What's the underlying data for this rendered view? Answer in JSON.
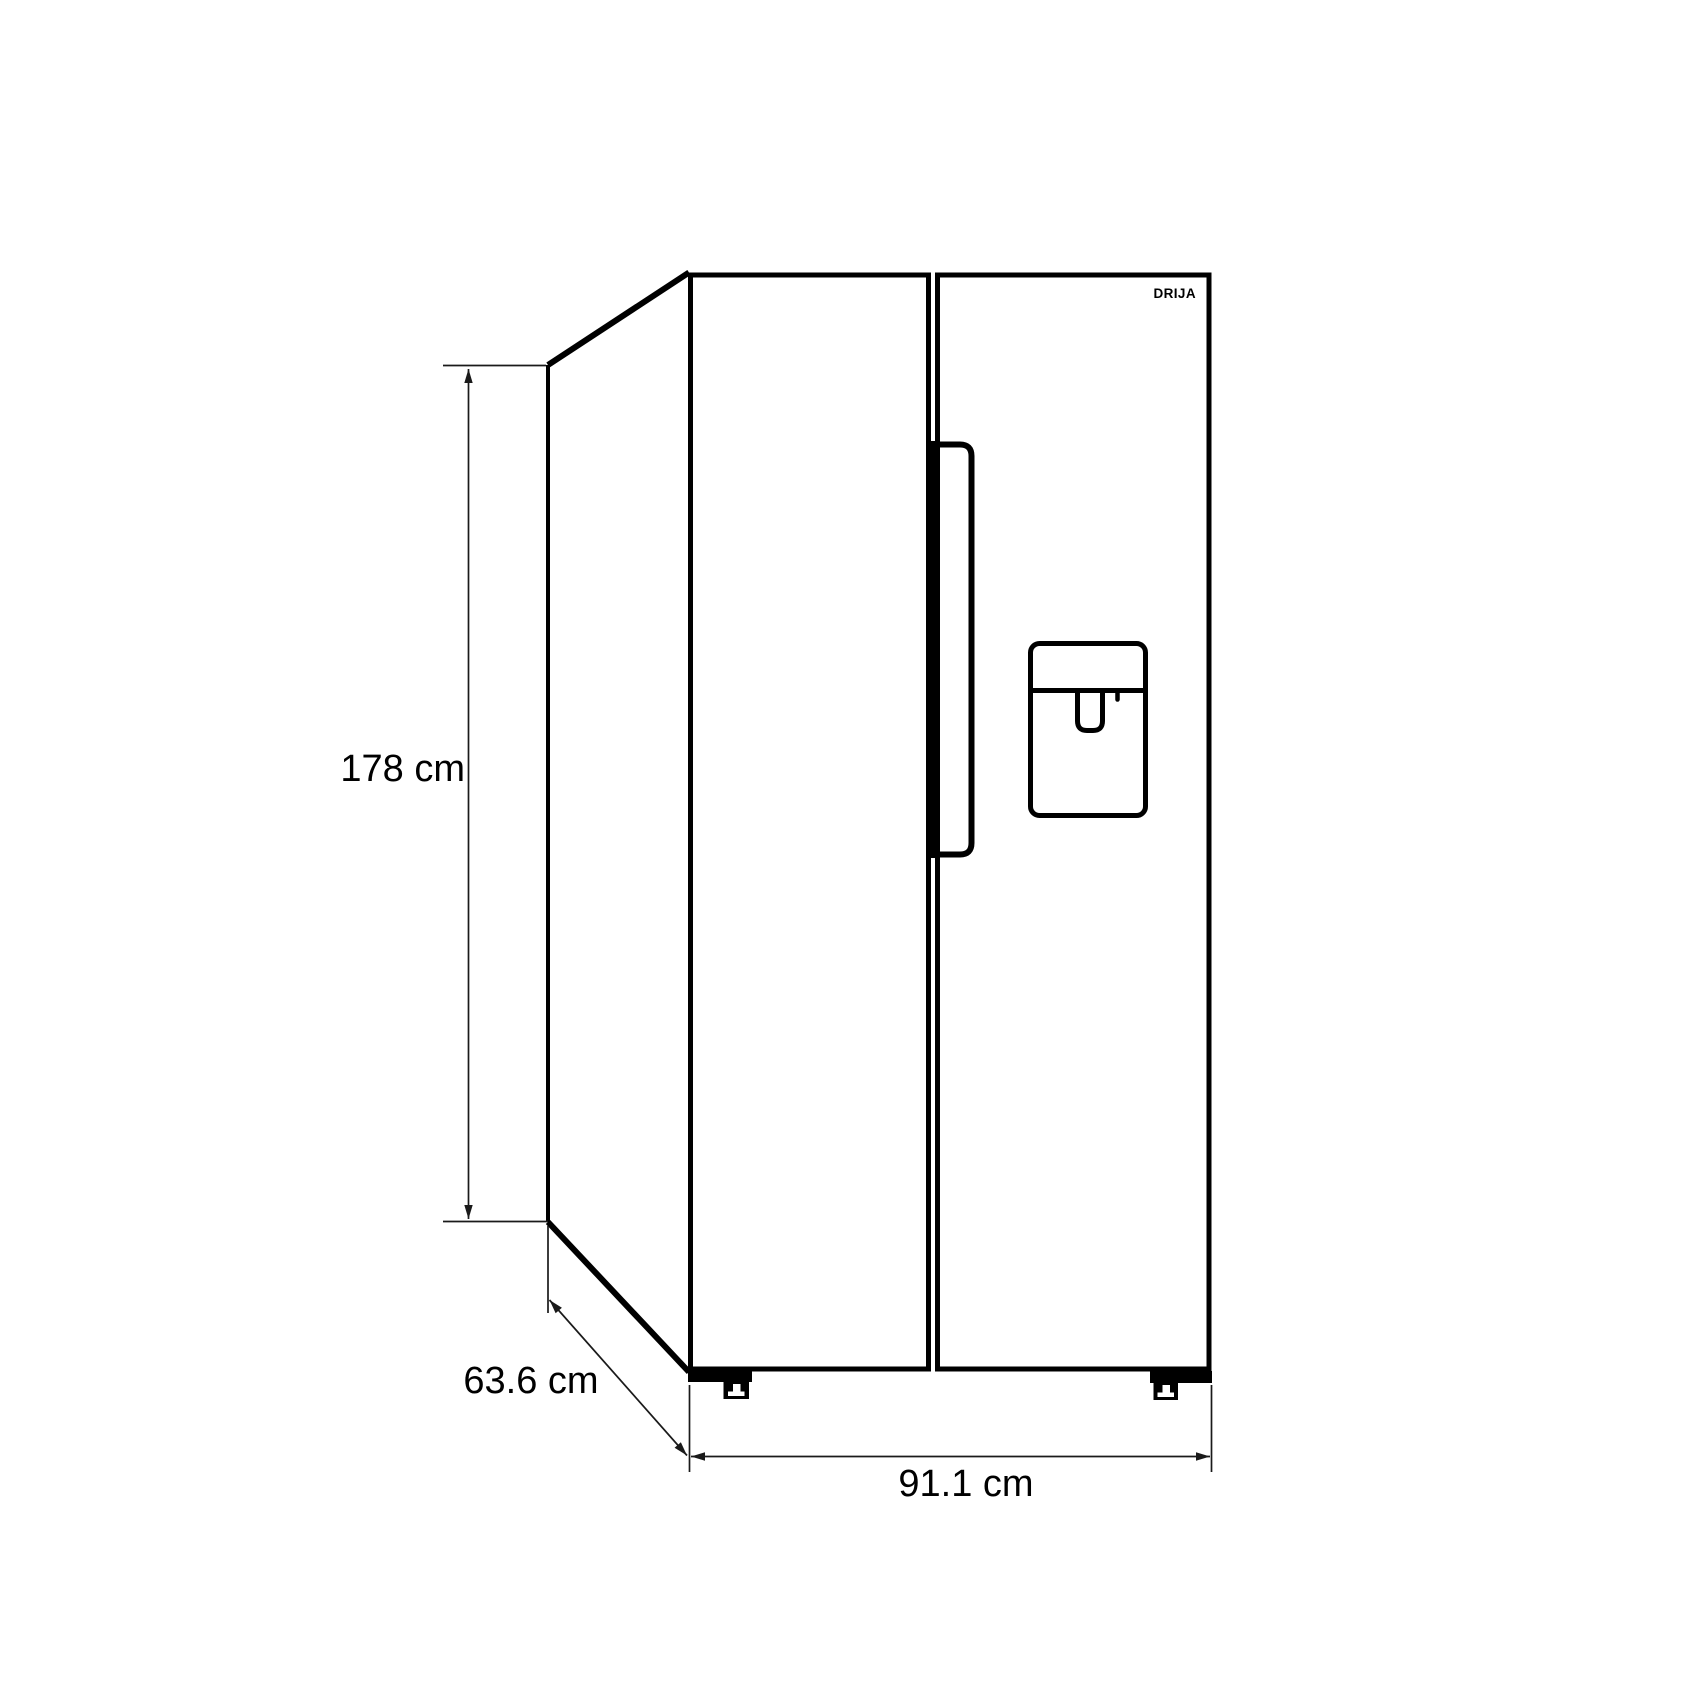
{
  "brand": {
    "logo_text": "DRIJA"
  },
  "dimensions": {
    "height_label": "178 cm",
    "depth_label": "63.6 cm",
    "width_label": "91.1 cm"
  },
  "colors": {
    "outline": "#000000",
    "dimension_line": "#1a1a1a",
    "background": "#ffffff"
  }
}
